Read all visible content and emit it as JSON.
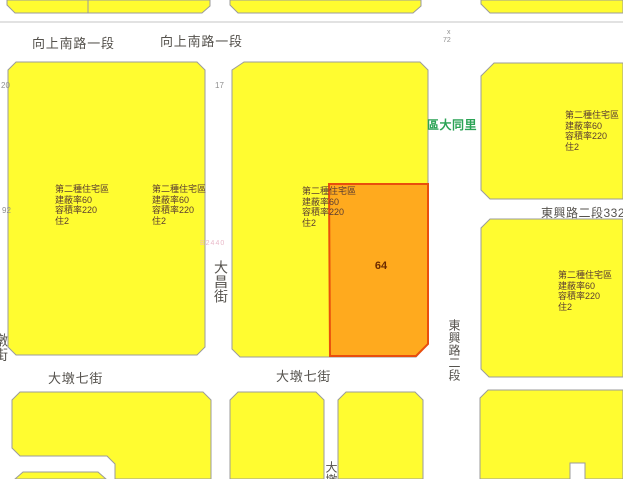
{
  "map": {
    "streets": {
      "xiangshang": "向上南路一段",
      "dadun7": "大墩七街",
      "dachang": "大昌街",
      "dongxing": "東興路二段",
      "dongxing_lane332": "東興路二段332巷",
      "left_edge_partial": "墩街",
      "bottom_partial": "大墩"
    },
    "district_label": "區大同里",
    "selected_parcel": {
      "number": "64"
    },
    "zone": {
      "lines": [
        "第二種住宅區",
        "建蔽率60",
        "容積率220",
        "住2"
      ]
    },
    "markers": {
      "n20": "20",
      "n17": "17",
      "n92": "92",
      "x_mark": "x",
      "n72": "72",
      "pink_code": "B2440"
    }
  },
  "colors": {
    "background": "#ffffff",
    "block_fill": "#fffc30",
    "block_stroke": "#9b9b9b",
    "parcel_fill": "#ffaa1e",
    "parcel_stroke": "#e94e0d",
    "street_text": "#55524d",
    "zone_text": "#5a3c32",
    "district_text": "#2ba355",
    "parcel_text": "#6b2a00",
    "marker_text": "#8f8f8f",
    "pink_text": "#e9b9c9",
    "road_line": "#c4c4c4"
  }
}
